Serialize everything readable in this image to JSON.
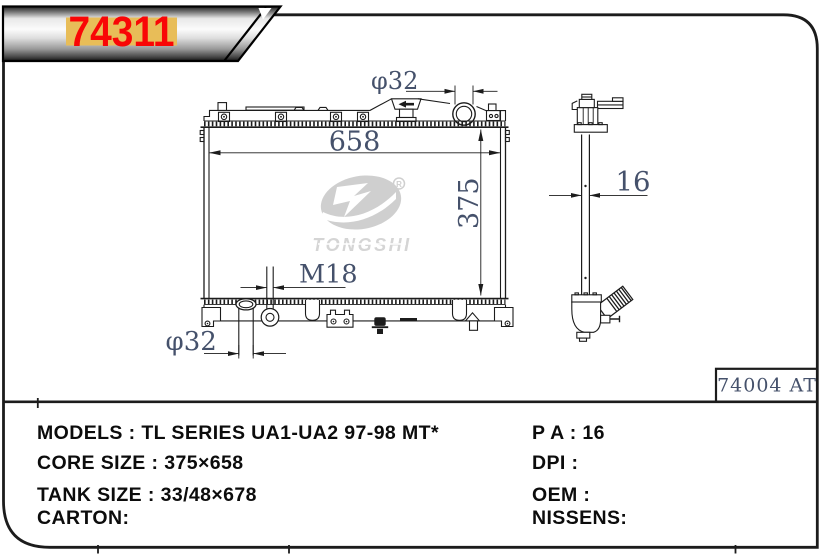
{
  "banner": {
    "part_number": "74311"
  },
  "drawing": {
    "dimensions": {
      "top_neck_diameter": "φ32",
      "core_width": "658",
      "core_height": "375",
      "oil_cooler_thread": "M18",
      "outlet_pipe_diameter": "φ32",
      "core_thickness": "16"
    },
    "reference_code": "74004 AT",
    "watermark_brand": "TONGSHI",
    "watermark_registered": "R"
  },
  "specs": {
    "left_lines": [
      "MODELS : TL SERIES UA1-UA2 97-98 MT*",
      "CORE SIZE : 375×658",
      "TANK SIZE : 33/48×678",
      "CARTON:"
    ],
    "right_lines": [
      "P A : 16",
      "DPI :",
      "OEM :",
      "NISSENS:"
    ]
  },
  "colors": {
    "line": "#1c1c1c",
    "dim_text": "#45516b",
    "banner_red": "#f90606",
    "banner_gold": "#e8bd58",
    "watermark": "#ababab"
  }
}
